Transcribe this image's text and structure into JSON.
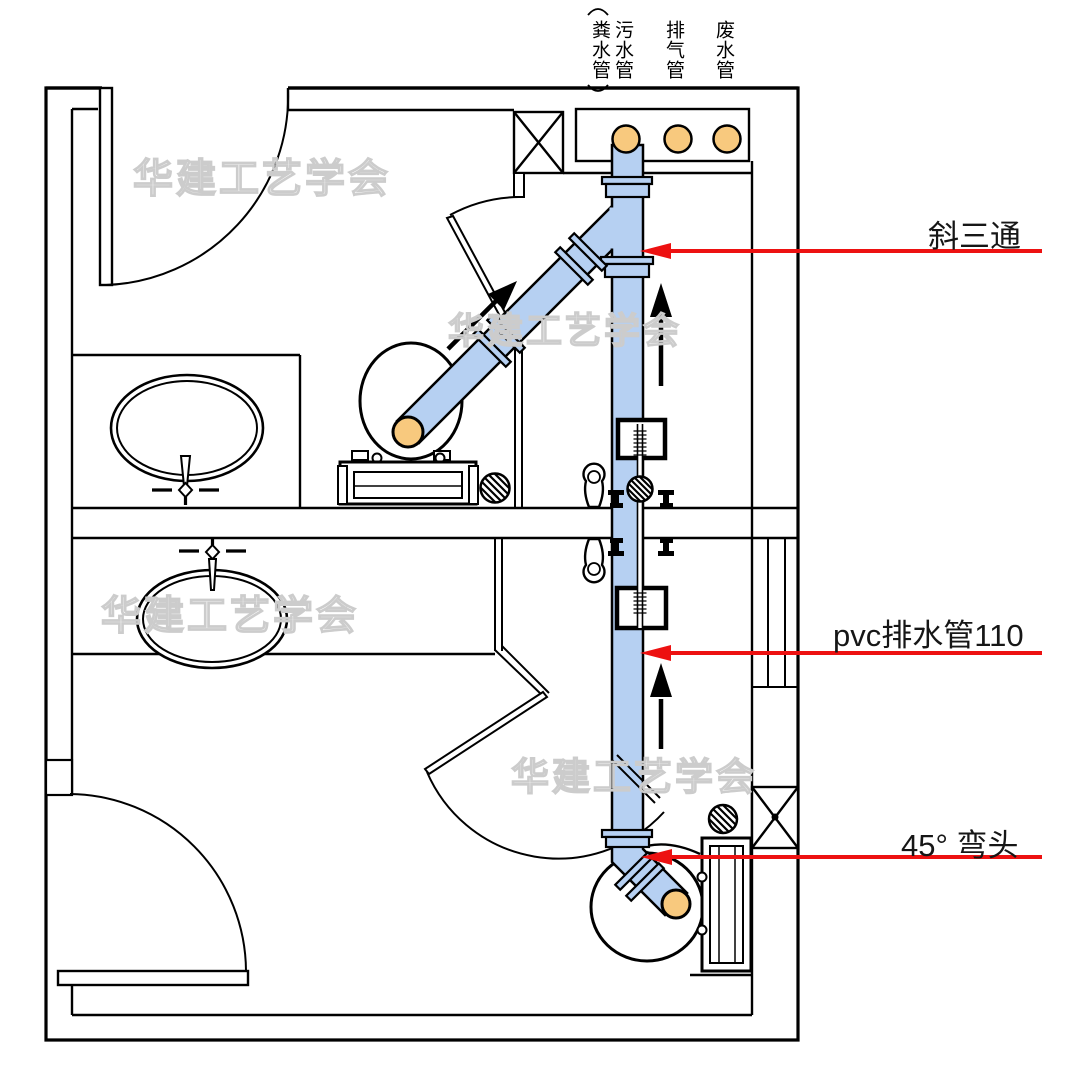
{
  "plan": {
    "riser_labels": [
      {
        "label": "粪水管",
        "bracketed": true
      },
      {
        "label": "污水管",
        "bracketed": false
      },
      {
        "label": "排气管",
        "bracketed": false
      },
      {
        "label": "废水管",
        "bracketed": false
      }
    ],
    "annotations": [
      {
        "label": "斜三通"
      },
      {
        "label": "pvc排水管110"
      },
      {
        "label": "45° 弯头"
      }
    ],
    "watermark_text": "华建工艺学会",
    "colors": {
      "pipe_blue": "#b6d0f2",
      "riser_orange": "#f8c97e",
      "arrow_red": "#ed1111",
      "watermark_gray": "#cccccc",
      "line_black": "#000000"
    }
  }
}
